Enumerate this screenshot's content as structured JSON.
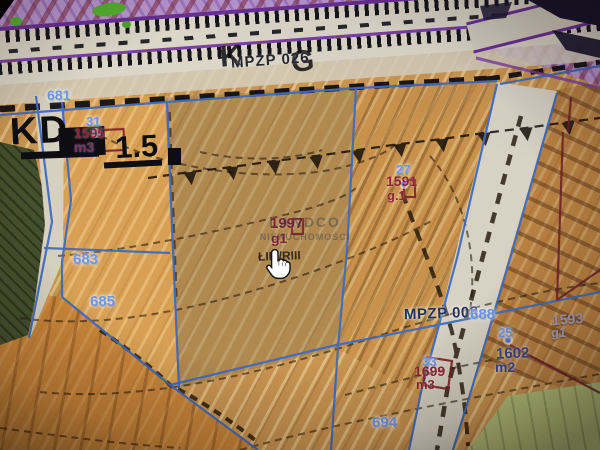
{
  "map": {
    "plan_labels": {
      "mpzp_026": "MPZP 026",
      "mpzp_008": "MPZP 008",
      "road_class_k": "K",
      "road_class_g": "G",
      "road_kd": "KD",
      "road_kd_value": "1.5"
    },
    "parcel_numbers": {
      "p681": "681",
      "p683": "683",
      "p685": "685",
      "p688": "688",
      "p694": "694"
    },
    "point_numbers": {
      "pt25": "25",
      "pt27": "27",
      "pt31": "31",
      "pt33": "33"
    },
    "annotations": {
      "n1595": "1595",
      "m3_a": "m3",
      "n1997": "1997",
      "g1_a": "g1",
      "soil_class": "ŁIII./RIII",
      "n1591": "1591",
      "g1_b": "g.1",
      "n1602": "1602",
      "m2": "m2",
      "n1593": "1593",
      "g1_c": "g1",
      "n1699": "1699",
      "m3_b": "m3"
    },
    "watermark": {
      "line1": "LANDCO",
      "line2": "NIERUCHOMOŚCI"
    },
    "cursor_icon": "hand-pointer",
    "colors": {
      "parcel_number_blue": "#6f96e2",
      "annotation_red": "#8f2438",
      "plan_label_navy": "#23355e",
      "zone_purple": "#bb99d4",
      "zone_orange": "#cfa05c",
      "zone_green_dark": "#45502e",
      "zone_green_light": "#b6c47c",
      "boundary_blue": "#3e6cc0"
    }
  }
}
